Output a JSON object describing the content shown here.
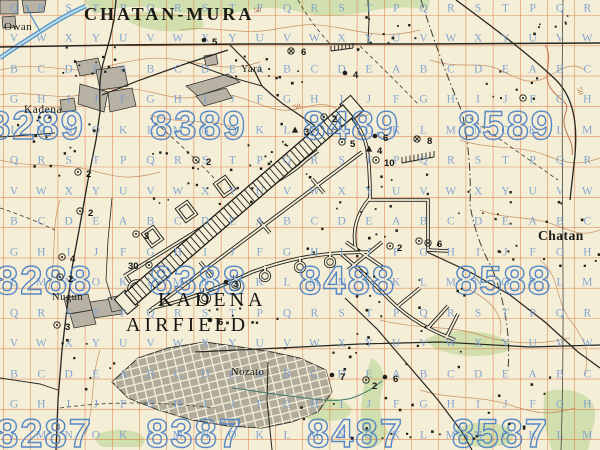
{
  "map": {
    "region_title": "CHATAN-MURA",
    "colors": {
      "paper": "#f4eed7",
      "grid_orange": "#e0753a",
      "overprint_blue": "#4f83c4",
      "letter_blue": "#7b9fd0",
      "vegetation_green": "#c9dba4",
      "contour_brown": "#bf8150",
      "urban_gray": "#b7b2a3",
      "road_black": "#26261f",
      "water_blue": "#4a90c4"
    },
    "place_labels": [
      {
        "id": "chatan-mura",
        "text": "CHATAN-MURA",
        "x": 84,
        "y": 20,
        "size": 18,
        "ls": 3,
        "weight": "600"
      },
      {
        "id": "owan",
        "text": "Owan",
        "x": 4,
        "y": 30,
        "size": 11,
        "ls": 0.5,
        "weight": "400"
      },
      {
        "id": "kadena",
        "text": "Kadena",
        "x": 24,
        "y": 113,
        "size": 11.5,
        "ls": 0.5,
        "weight": "400"
      },
      {
        "id": "yara",
        "text": "Yara",
        "x": 241,
        "y": 72,
        "size": 10.5,
        "ls": 0.5,
        "weight": "400"
      },
      {
        "id": "chatan",
        "text": "Chatan",
        "x": 538,
        "y": 240,
        "size": 13.5,
        "ls": 0.5,
        "weight": "600"
      },
      {
        "id": "nugun",
        "text": "Nugun",
        "x": 52,
        "y": 300,
        "size": 10.5,
        "ls": 0.5,
        "weight": "400"
      },
      {
        "id": "nozato",
        "text": "Nozato",
        "x": 231,
        "y": 375,
        "size": 10.5,
        "ls": 0.5,
        "weight": "400"
      }
    ],
    "airfield_label": {
      "line1": "KADENA",
      "line2": "AIRFIELD",
      "x1": 158,
      "y1": 306,
      "x2": 126,
      "y2": 331,
      "size": 20,
      "ls": 4
    },
    "grid_numbers": [
      {
        "text": "8289",
        "x": -12,
        "y": 139
      },
      {
        "text": "8389",
        "x": 150,
        "y": 139
      },
      {
        "text": "8489",
        "x": 303,
        "y": 139
      },
      {
        "text": "8589",
        "x": 458,
        "y": 139
      },
      {
        "text": "8288",
        "x": -4,
        "y": 294
      },
      {
        "text": "8388",
        "x": 150,
        "y": 294
      },
      {
        "text": "8488",
        "x": 299,
        "y": 294
      },
      {
        "text": "8588",
        "x": 455,
        "y": 294
      },
      {
        "text": "8287",
        "x": -4,
        "y": 447
      },
      {
        "text": "8387",
        "x": 146,
        "y": 447
      },
      {
        "text": "8487",
        "x": 307,
        "y": 447
      },
      {
        "text": "8587",
        "x": 452,
        "y": 447
      }
    ],
    "letter_grid": {
      "x0": 14,
      "dx": 27.3,
      "phase": 1,
      "columns": 22,
      "rows": [
        {
          "y": 7,
          "cycle": "PQRST"
        },
        {
          "y": 37,
          "cycle": "UVWXY"
        },
        {
          "y": 68,
          "cycle": "ABCDE"
        },
        {
          "y": 98,
          "cycle": "FGHIJ"
        },
        {
          "y": 129,
          "cycle": "KLMNO"
        },
        {
          "y": 159,
          "cycle": "PQRST"
        },
        {
          "y": 190,
          "cycle": "UVWXY"
        },
        {
          "y": 220,
          "cycle": "ABCDE"
        },
        {
          "y": 251,
          "cycle": "FGHIJ"
        },
        {
          "y": 281,
          "cycle": "KLMNO"
        },
        {
          "y": 312,
          "cycle": "PQRST"
        },
        {
          "y": 342,
          "cycle": "UVWXY"
        },
        {
          "y": 373,
          "cycle": "ABCDE"
        },
        {
          "y": 403,
          "cycle": "FGHIJ"
        },
        {
          "y": 434,
          "cycle": "KLMNO"
        }
      ]
    },
    "contour_labels": [
      {
        "text": "50",
        "x": 294,
        "y": 110,
        "rot": -15
      },
      {
        "text": "50",
        "x": 577,
        "y": 88,
        "rot": 75
      },
      {
        "text": "50",
        "x": 254,
        "y": 13,
        "rot": -10
      }
    ],
    "target_markers": [
      {
        "t": "circle-x",
        "x": 291,
        "y": 51,
        "n": "6",
        "lx": 301,
        "ly": 55
      },
      {
        "t": "dot",
        "x": 345,
        "y": 73,
        "n": "4",
        "lx": 353,
        "ly": 78
      },
      {
        "t": "dot",
        "x": 204,
        "y": 40,
        "n": "5",
        "lx": 212,
        "ly": 45
      },
      {
        "t": "circle-x",
        "x": 417,
        "y": 139,
        "n": "8",
        "lx": 427,
        "ly": 144
      },
      {
        "t": "triangle",
        "x": 295,
        "y": 130,
        "n": "3",
        "lx": 304,
        "ly": 135
      },
      {
        "t": "circle-dot",
        "x": 324,
        "y": 117,
        "n": "2",
        "lx": 332,
        "ly": 122
      },
      {
        "t": "circle-dot",
        "x": 342,
        "y": 142,
        "n": "5",
        "lx": 350,
        "ly": 147
      },
      {
        "t": "dot",
        "x": 375,
        "y": 136,
        "n": "6",
        "lx": 383,
        "ly": 141
      },
      {
        "t": "triangle",
        "x": 369,
        "y": 149,
        "n": "4",
        "lx": 377,
        "ly": 154
      },
      {
        "t": "circle-dot",
        "x": 376,
        "y": 160,
        "n": "10",
        "lx": 384,
        "ly": 166
      },
      {
        "t": "circle-dot",
        "x": 419,
        "y": 241,
        "n": "",
        "lx": 0,
        "ly": 0
      },
      {
        "t": "circle-dot",
        "x": 428,
        "y": 243,
        "n": "6",
        "lx": 437,
        "ly": 247
      },
      {
        "t": "circle-dot",
        "x": 136,
        "y": 234,
        "n": "3",
        "lx": 144,
        "ly": 239
      },
      {
        "t": "circle-dot",
        "x": 149,
        "y": 265,
        "n": "30",
        "lx": 128,
        "ly": 269
      },
      {
        "t": "circle-dot",
        "x": 78,
        "y": 172,
        "n": "2",
        "lx": 86,
        "ly": 177
      },
      {
        "t": "circle-dot",
        "x": 80,
        "y": 211,
        "n": "2",
        "lx": 88,
        "ly": 216
      },
      {
        "t": "circle-dot",
        "x": 196,
        "y": 160,
        "n": "2",
        "lx": 206,
        "ly": 165
      },
      {
        "t": "circle-dot",
        "x": 62,
        "y": 257,
        "n": "4",
        "lx": 70,
        "ly": 262
      },
      {
        "t": "circle-dot",
        "x": 60,
        "y": 277,
        "n": "2",
        "lx": 68,
        "ly": 282
      },
      {
        "t": "circle-dot",
        "x": 57,
        "y": 325,
        "n": "3",
        "lx": 65,
        "ly": 330
      },
      {
        "t": "dot",
        "x": 226,
        "y": 282,
        "n": "3",
        "lx": 233,
        "ly": 287
      },
      {
        "t": "dot",
        "x": 210,
        "y": 320,
        "n": "6",
        "lx": 218,
        "ly": 325
      },
      {
        "t": "dot",
        "x": 332,
        "y": 375,
        "n": "7",
        "lx": 340,
        "ly": 380
      },
      {
        "t": "circle-dot",
        "x": 366,
        "y": 380,
        "n": "2",
        "lx": 372,
        "ly": 389
      },
      {
        "t": "dot",
        "x": 385,
        "y": 377,
        "n": "6",
        "lx": 393,
        "ly": 382
      },
      {
        "t": "circle-dot",
        "x": 390,
        "y": 246,
        "n": "2",
        "lx": 397,
        "ly": 251
      },
      {
        "t": "circle-dot",
        "x": 523,
        "y": 98,
        "n": "",
        "lx": 0,
        "ly": 0
      }
    ],
    "building_clusters": [
      {
        "x": 55,
        "y": 45,
        "w": 70,
        "h": 30,
        "n": 14
      },
      {
        "x": 15,
        "y": 115,
        "w": 80,
        "h": 60,
        "n": 16
      },
      {
        "x": 225,
        "y": 55,
        "w": 80,
        "h": 45,
        "n": 12
      },
      {
        "x": 355,
        "y": 15,
        "w": 60,
        "h": 35,
        "n": 10
      },
      {
        "x": 530,
        "y": 15,
        "w": 45,
        "h": 25,
        "n": 7
      },
      {
        "x": 150,
        "y": 140,
        "w": 120,
        "h": 70,
        "n": 18
      },
      {
        "x": 300,
        "y": 170,
        "w": 130,
        "h": 90,
        "n": 22
      },
      {
        "x": 330,
        "y": 270,
        "w": 140,
        "h": 100,
        "n": 26
      },
      {
        "x": 430,
        "y": 190,
        "w": 90,
        "h": 70,
        "n": 14
      },
      {
        "x": 540,
        "y": 195,
        "w": 60,
        "h": 70,
        "n": 10
      },
      {
        "x": 200,
        "y": 300,
        "w": 90,
        "h": 50,
        "n": 10
      },
      {
        "x": 300,
        "y": 395,
        "w": 120,
        "h": 50,
        "n": 12
      },
      {
        "x": 430,
        "y": 370,
        "w": 120,
        "h": 70,
        "n": 12
      },
      {
        "x": 60,
        "y": 330,
        "w": 60,
        "h": 60,
        "n": 8
      },
      {
        "x": 480,
        "y": 60,
        "w": 70,
        "h": 50,
        "n": 8
      },
      {
        "x": 240,
        "y": 120,
        "w": 60,
        "h": 45,
        "n": 10
      }
    ]
  }
}
